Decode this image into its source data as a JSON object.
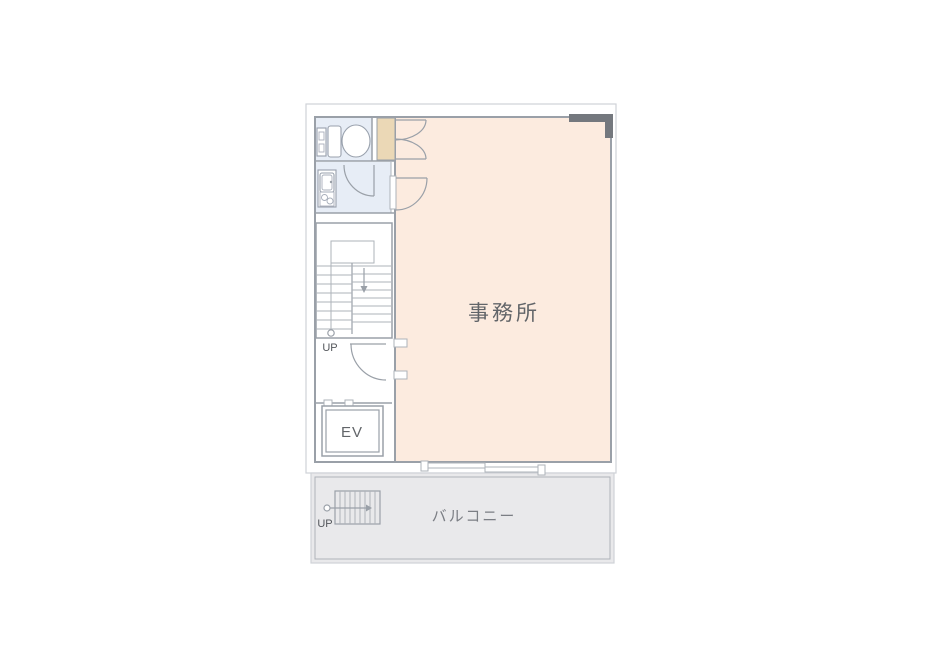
{
  "floorplan": {
    "labels": {
      "office": "事務所",
      "balcony": "バルコニー",
      "elevator": "EV",
      "stairs_up": "UP",
      "balcony_stairs_up": "UP"
    },
    "colors": {
      "office_fill": "#fcebdf",
      "wet_area_fill": "#e7edf6",
      "closet_fill": "#ebd8b6",
      "balcony_fill": "#e9e9eb",
      "wall_line": "#9aa0a8",
      "light_line": "#aeb3ba",
      "outline": "#cfd2d7",
      "accent_wall": "#74787e",
      "room_text": "#626569",
      "balcony_text": "#7b7e84",
      "up_text": "#53565b",
      "page_bg": "#ffffff"
    }
  }
}
